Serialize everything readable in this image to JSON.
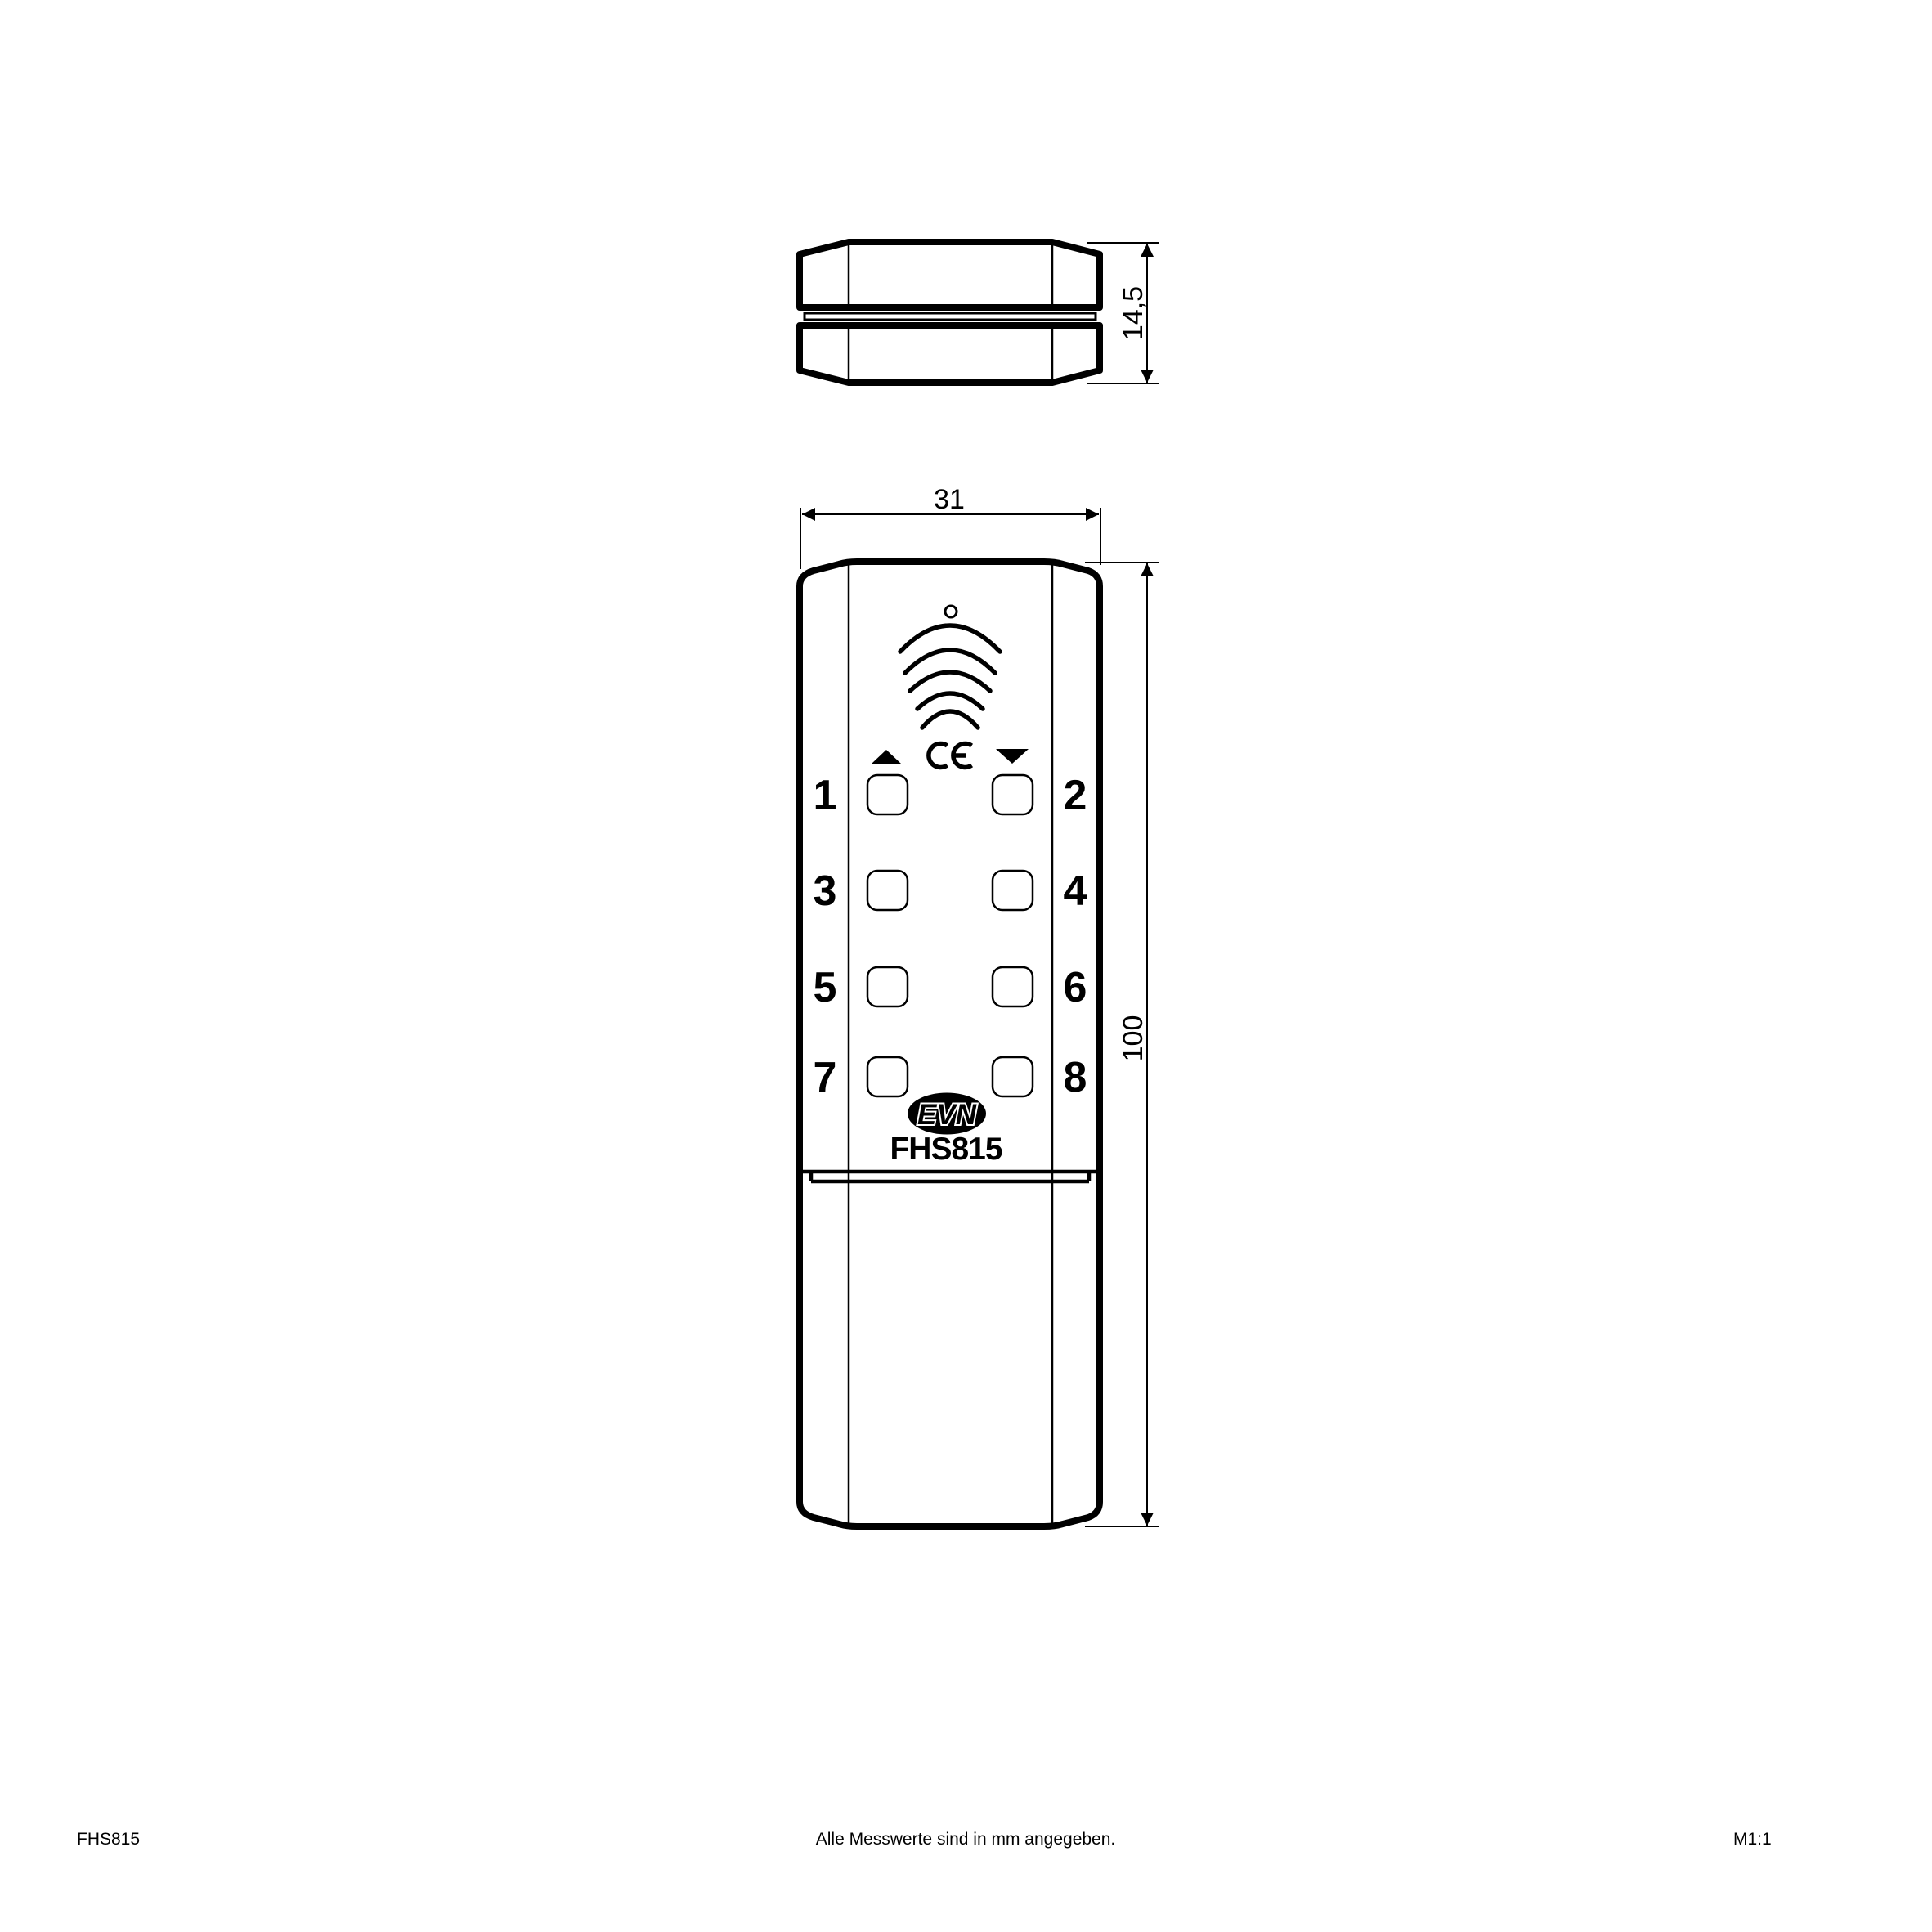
{
  "drawing": {
    "product": "FHS815",
    "scale": "M1:1",
    "note": "Alle Messwerte sind in mm angegeben.",
    "dimensions": {
      "side_height": "14,5",
      "front_width": "31",
      "front_height": "100"
    },
    "front": {
      "button_labels": [
        "1",
        "2",
        "3",
        "4",
        "5",
        "6",
        "7",
        "8"
      ],
      "brand": "EVN",
      "model": "FHS815",
      "ce_mark": "CE"
    }
  }
}
